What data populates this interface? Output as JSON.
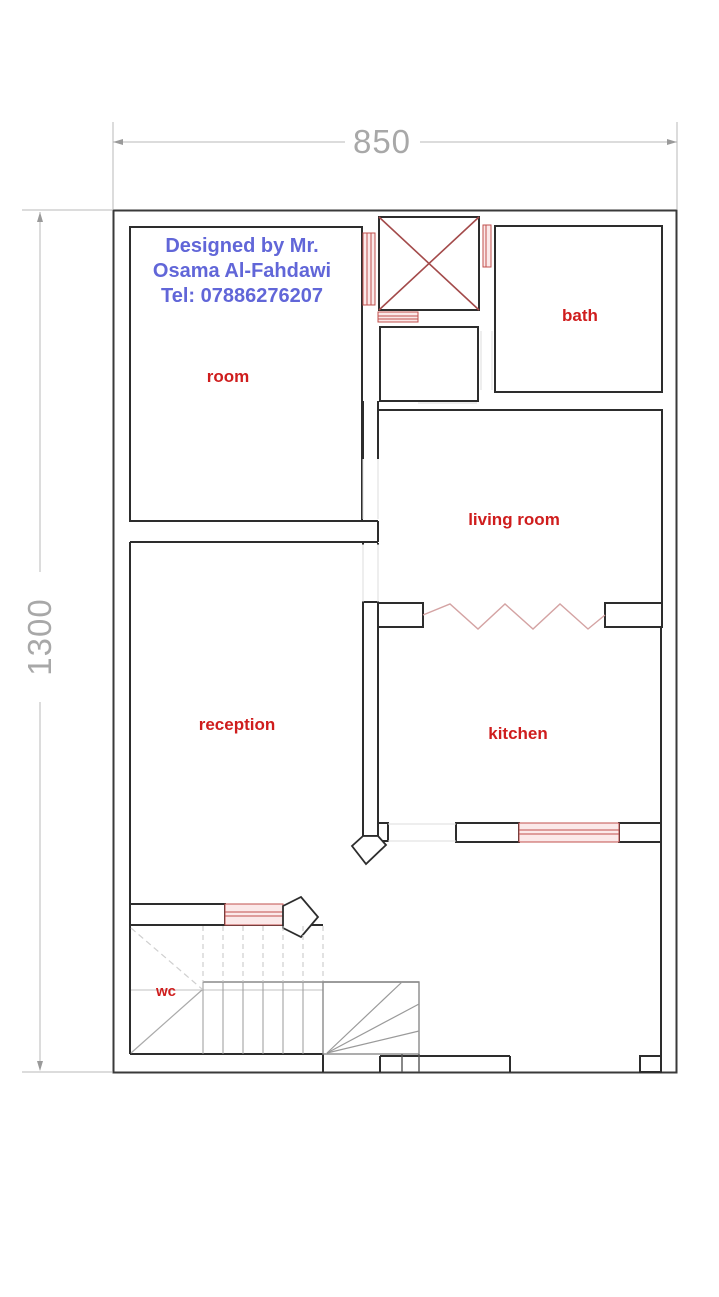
{
  "dimensions": {
    "width": "850",
    "height": "1300"
  },
  "designer_note": {
    "lines": [
      "Designed by Mr.",
      "Osama Al-Fahdawi",
      "Tel: 07886276207"
    ]
  },
  "rooms": {
    "room": "room",
    "bath": "bath",
    "living_room": "living room",
    "reception": "reception",
    "kitchen": "kitchen",
    "wc": "wc"
  },
  "colors": {
    "wall": "#2d2d2d",
    "outer_wall": "#3a3a3a",
    "dimension": "#a8a8a8",
    "room_label": "#cf1d1d",
    "designer_note": "#6166d8",
    "window_stroke": "#c0504d",
    "window_fill": "#fbe9e9",
    "shaft_cross": "#a34a4a",
    "zigzag": "#d4a3a3",
    "stair_line": "#9a9a9a",
    "stair_dashed": "#c6c6c6",
    "opening": "#dcdcdc"
  }
}
